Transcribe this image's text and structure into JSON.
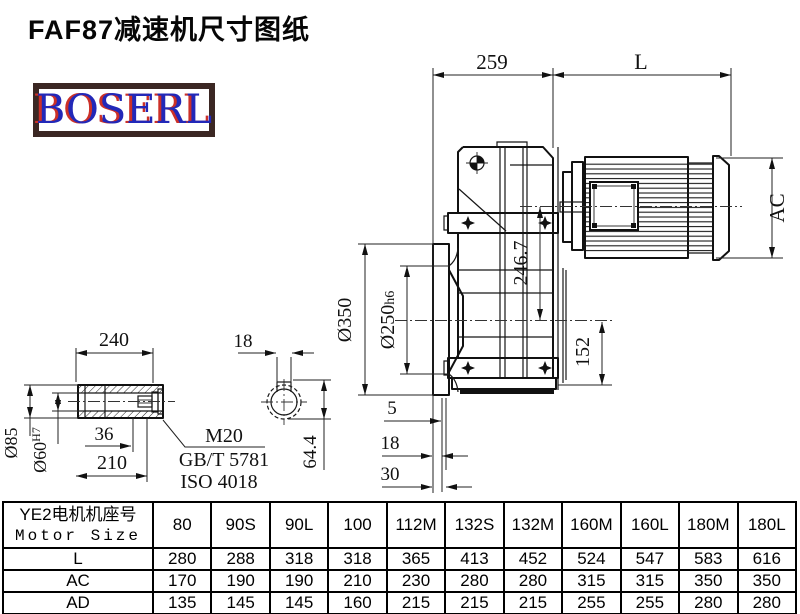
{
  "title": "FAF87减速机尺寸图纸",
  "logo": {
    "text": "BOSERL",
    "text_color": "#2228b8",
    "shadow_color": "#cc3028",
    "border_color": "#3b2723"
  },
  "drawing": {
    "dims": {
      "gearbox_length": "259",
      "motor_length": "L",
      "motor_diameter": "AC",
      "axis_height": "246.7",
      "output_axis_to_base": "152",
      "flange_od": "Ø350",
      "spigot_main": "Ø250",
      "spigot_tol": "h6",
      "face_offset_5": "5",
      "face_offset_18": "18",
      "face_offset_30": "30",
      "shaft_length": "240",
      "key_width": "18",
      "shaft_od": "Ø85",
      "bore_main": "Ø60",
      "bore_tol": "H7",
      "bore_step": "36",
      "bore_depth": "210",
      "keyway_depth": "64.4",
      "bolt_thread": "M20",
      "bolt_std_gb": "GB/T 5781",
      "bolt_std_iso": "ISO 4018"
    }
  },
  "table": {
    "header": {
      "line1": "YE2电机机座号",
      "line2": "Motor Size"
    },
    "columns": [
      "80",
      "90S",
      "90L",
      "100",
      "112M",
      "132S",
      "132M",
      "160M",
      "160L",
      "180M",
      "180L"
    ],
    "rows": [
      {
        "label": "L",
        "values": [
          280,
          288,
          318,
          318,
          365,
          413,
          452,
          524,
          547,
          583,
          616
        ]
      },
      {
        "label": "AC",
        "values": [
          170,
          190,
          190,
          210,
          230,
          280,
          280,
          315,
          315,
          350,
          350
        ]
      },
      {
        "label": "AD",
        "values": [
          135,
          145,
          145,
          160,
          215,
          215,
          215,
          255,
          255,
          280,
          280
        ]
      }
    ]
  }
}
